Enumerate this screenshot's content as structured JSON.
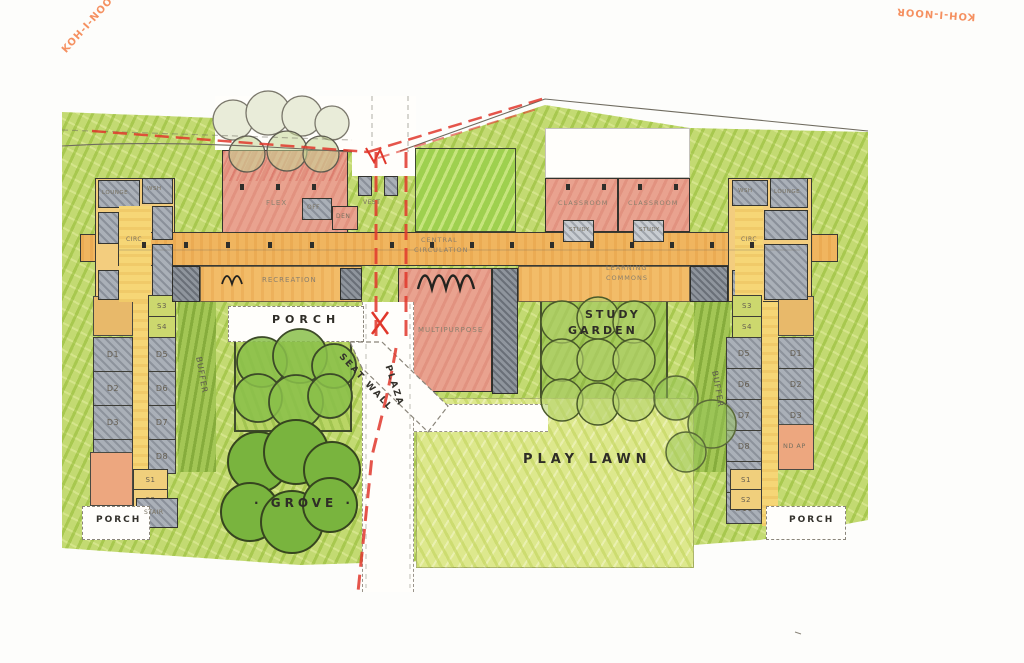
{
  "watermark": {
    "top_left": "KOH-I-NOOR",
    "top_right": "KOH-I-NOOR"
  },
  "site": {
    "porch_center": "PORCH",
    "seat_wall": "SEAT WALL",
    "plaza": "PLAZA",
    "grove": "· GROVE ·",
    "play_lawn": "PLAY LAWN",
    "study": "STUDY",
    "garden": "GARDEN",
    "buffer_left": "BUFFER",
    "buffer_right": "BUFFER",
    "porch_bottom_left": "PORCH",
    "porch_bottom_right": "PORCH"
  },
  "building": {
    "flex": "FLEX",
    "off": "OFF",
    "den": "DEN",
    "vest": "VEST",
    "recreation": "RECREATION",
    "central_circ_1": "CENTRAL",
    "central_circ_2": "CIRCULATION",
    "multipurpose": "MULTIPURPOSE",
    "classroom_a": "CLASSROOM",
    "classroom_b": "CLASSROOM",
    "study_a": "STUDY",
    "study_b": "STUDY",
    "learning_1": "LEARNING",
    "learning_2": "COMMONS",
    "circ_left": "CIRC",
    "circ_right": "CIRC",
    "lounge_left": "LOUNGE",
    "wsh_left": "WSH",
    "wsh_right": "WSH",
    "lounge_right": "LOUNGE",
    "stair_left": "STAIR",
    "nd_ap": "ND AP"
  },
  "rooms": {
    "left_wing": {
      "top": [
        "S3",
        "S4"
      ],
      "col_a": [
        "D1",
        "D2",
        "D3",
        "D4"
      ],
      "col_b": [
        "D5",
        "D6",
        "D7",
        "D8"
      ],
      "bottom": [
        "S1",
        "S2"
      ]
    },
    "right_wing": {
      "top": [
        "S3",
        "S4"
      ],
      "col_a": [
        "D5",
        "D6",
        "D7",
        "D8",
        "D9",
        "D10"
      ],
      "col_b": [
        "D1",
        "D2",
        "D3",
        "D4"
      ],
      "bottom": [
        "S1",
        "S2"
      ]
    }
  },
  "colors": {
    "red_line": "#e0372b",
    "marker_green": "#c3da72",
    "lawn_green": "#dde88d",
    "tree_green": "#76b23c",
    "orange_band": "#f0b55f",
    "pink_block": "#e9a28f",
    "yellow_wing": "#f3cd7e",
    "gray_room": "#aab0b8",
    "watermark_orange": "#f4824a"
  }
}
